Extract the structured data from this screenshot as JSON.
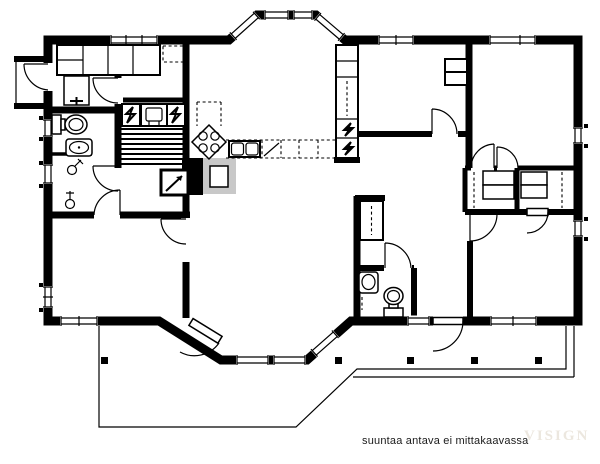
{
  "footer": {
    "caption": "suuntaa antava ei mittakaavassa",
    "watermark": "VISIGN"
  },
  "colors": {
    "background": "#ffffff",
    "wall": "#000000",
    "chimney_gray": "#c8c8c8",
    "caption_text": "#1b1b1b",
    "watermark_text": "#ece7df"
  },
  "plan": {
    "type": "single-storey house floor plan",
    "fixtures": [
      "toilet-icon",
      "washbasin-icon",
      "laundry-sink-icon",
      "floor-drain-icon",
      "sauna-heater-icon",
      "lightning-bolt-icon",
      "sauna-bench-icon",
      "fireplace-icon",
      "chimney-icon",
      "stove-icon",
      "kitchen-sink-icon",
      "dishwasher-icon",
      "wardrobe-icon",
      "closet-icon",
      "door-swing-icon",
      "window-icon",
      "terrace-post-icon",
      "second-toilet-icon",
      "second-washbasin-icon"
    ],
    "features": [
      "canted-entrance-bay",
      "canted-living-room-bay",
      "terrace",
      "entry-porch",
      "sauna",
      "washroom",
      "wc",
      "utility-room",
      "kitchen",
      "living-room",
      "three-bedrooms",
      "walk-in-closets",
      "hall",
      "corridor",
      "bathroom"
    ]
  }
}
